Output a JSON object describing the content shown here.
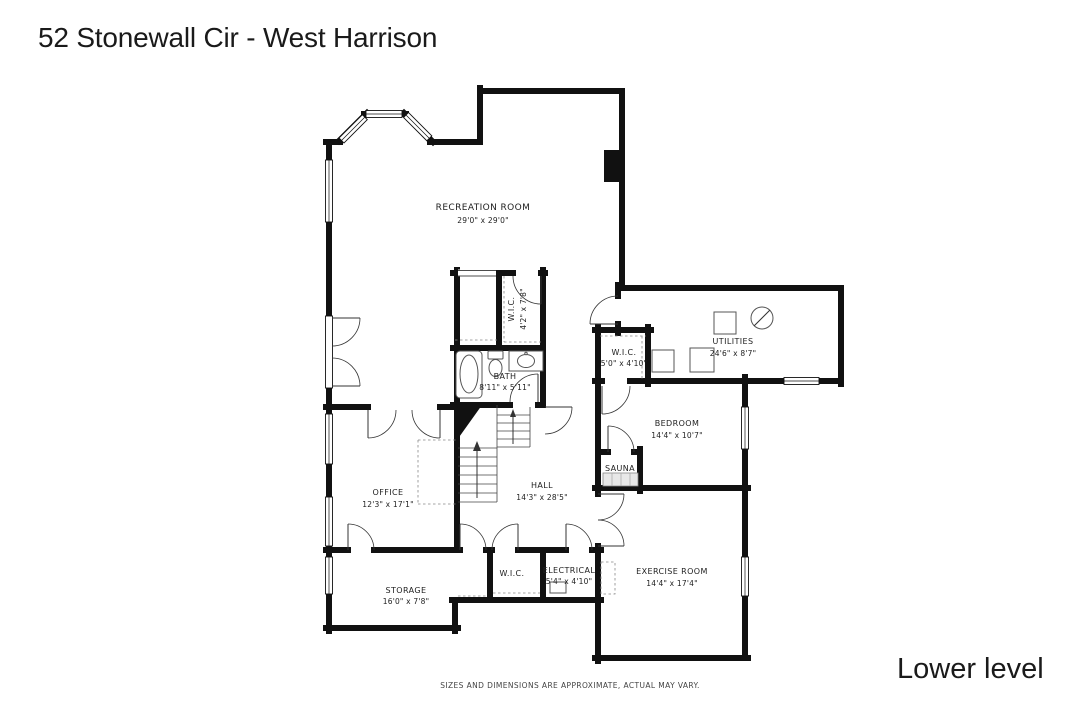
{
  "header": {
    "title": "52 Stonewall Cir - West Harrison"
  },
  "footer": {
    "disclaimer": "SIZES AND DIMENSIONS ARE APPROXIMATE, ACTUAL MAY VARY.",
    "level": "Lower level"
  },
  "colors": {
    "wall": "#111111",
    "background": "#ffffff",
    "label_text": "#222222",
    "fixture_stroke": "#555555"
  },
  "rooms": {
    "recreation": {
      "name": "RECREATION ROOM",
      "dims": "29'0\" x 29'0\""
    },
    "wic_upper": {
      "name": "W.I.C.",
      "dims": "4'2\" x 7'8\""
    },
    "bath": {
      "name": "BATH",
      "dims": "8'11\" x 5'11\""
    },
    "utilities": {
      "name": "UTILITIES",
      "dims": "24'6\" x 8'7\""
    },
    "wic_bedroom": {
      "name": "W.I.C.",
      "dims": "5'0\" x 4'10\""
    },
    "bedroom": {
      "name": "BEDROOM",
      "dims": "14'4\" x 10'7\""
    },
    "sauna": {
      "name": "SAUNA"
    },
    "office": {
      "name": "OFFICE",
      "dims": "12'3\" x 17'1\""
    },
    "hall": {
      "name": "HALL",
      "dims": "14'3\" x 28'5\""
    },
    "storage": {
      "name": "STORAGE",
      "dims": "16'0\" x 7'8\""
    },
    "wic_lower": {
      "name": "W.I.C."
    },
    "electrical": {
      "name": "ELECTRICAL",
      "dims": "5'4\" x 4'10\""
    },
    "exercise": {
      "name": "EXERCISE ROOM",
      "dims": "14'4\" x 17'4\""
    }
  }
}
